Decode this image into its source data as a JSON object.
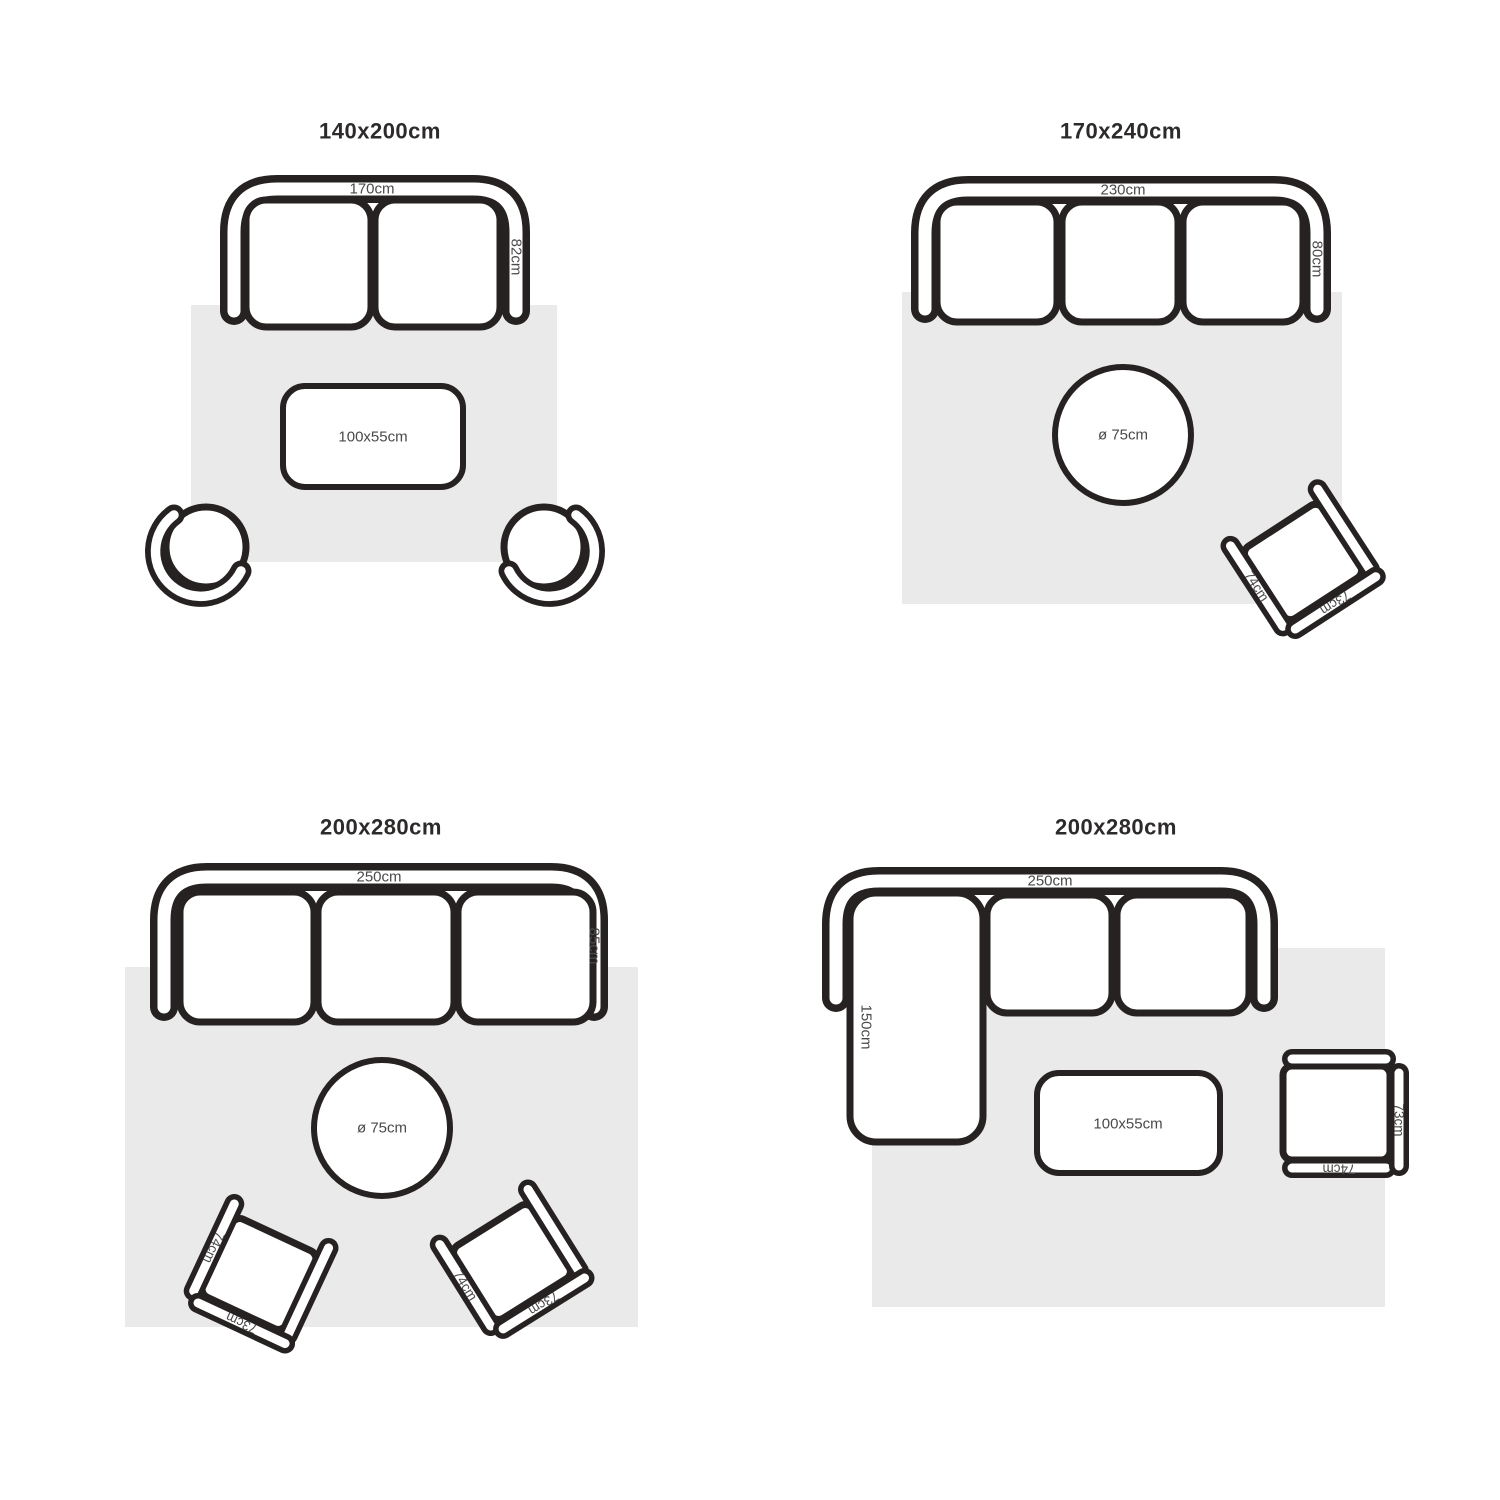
{
  "colors": {
    "outline": "#272222",
    "rug": "#eaeaea",
    "title-text": "#2d2a2a",
    "label-text": "#4a4a4a",
    "background": "#ffffff"
  },
  "quadrants": [
    {
      "title": "140x200cm",
      "sofa": {
        "type": "2-seat sofa",
        "width_label": "170cm",
        "depth_label": "82cm"
      },
      "coffee_table": {
        "label": "100x55cm"
      },
      "chairs": [
        {
          "type": "round chair"
        },
        {
          "type": "round chair"
        }
      ]
    },
    {
      "title": "170x240cm",
      "sofa": {
        "type": "3-seat sofa",
        "width_label": "230cm",
        "depth_label": "80cm"
      },
      "round_table": {
        "label": "ø 75cm"
      },
      "armchairs": [
        {
          "width_label": "74cm",
          "front_label": "73cm"
        }
      ]
    },
    {
      "title": "200x280cm",
      "sofa": {
        "type": "3-seat sofa",
        "width_label": "250cm",
        "depth_label": "85cm"
      },
      "round_table": {
        "label": "ø 75cm"
      },
      "armchairs": [
        {
          "width_label": "74cm",
          "front_label": "73cm"
        },
        {
          "width_label": "74cm",
          "front_label": "73cm"
        }
      ]
    },
    {
      "title": "200x280cm",
      "sofa": {
        "type": "corner sofa with chaise",
        "width_label": "250cm",
        "chaise_label": "150cm"
      },
      "coffee_table": {
        "label": "100x55cm"
      },
      "armchairs": [
        {
          "side_label": "73cm",
          "front_label": "74cm"
        }
      ]
    }
  ]
}
